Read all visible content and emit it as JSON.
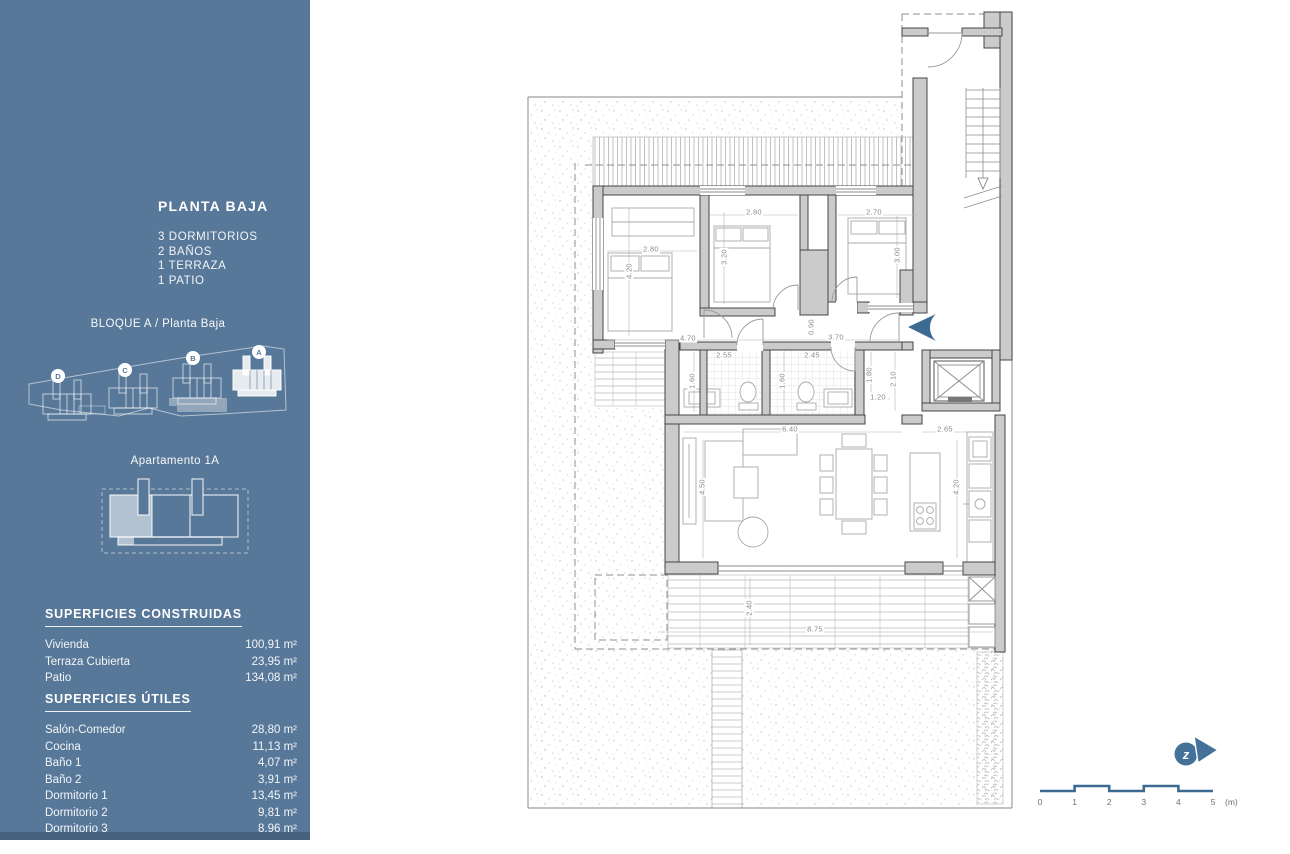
{
  "colors": {
    "sidebar_bg": "#587899",
    "sidebar_footer": "#46627f",
    "accent_blue": "#3c6a92",
    "wall_fill": "#cbcbcb",
    "wall_line": "#454545"
  },
  "sidebar": {
    "title": "PLANTA BAJA",
    "features": [
      "3 DORMITORIOS",
      "2 BAÑOS",
      "1 TERRAZA",
      "1 PATIO"
    ],
    "block_title": "BLOQUE A / Planta Baja",
    "block_units": [
      {
        "label": "D"
      },
      {
        "label": "C"
      },
      {
        "label": "B"
      },
      {
        "label": "A",
        "highlighted": true
      }
    ],
    "apartment_title": "Apartamento 1A",
    "built_areas": {
      "heading": "SUPERFICIES CONSTRUIDAS",
      "rows": [
        {
          "label": "Vivienda",
          "value": "100,91 m²"
        },
        {
          "label": "Terraza Cubierta",
          "value": "23,95 m²"
        },
        {
          "label": "Patio",
          "value": "134,08 m²"
        }
      ]
    },
    "usable_areas": {
      "heading": "SUPERFICIES ÚTILES",
      "rows": [
        {
          "label": "Salón-Comedor",
          "value": "28,80 m²"
        },
        {
          "label": "Cocina",
          "value": "11,13 m²"
        },
        {
          "label": "Baño 1",
          "value": "4,07 m²"
        },
        {
          "label": "Baño 2",
          "value": "3,91 m²"
        },
        {
          "label": "Dormitorio 1",
          "value": "13,45 m²"
        },
        {
          "label": "Dormitorio 2",
          "value": "9,81 m²"
        },
        {
          "label": "Dormitorio 3",
          "value": "8,96 m²"
        },
        {
          "label": "Paso",
          "value": "6,52 m²"
        }
      ]
    }
  },
  "plan": {
    "dimensions": [
      {
        "text": "2.80",
        "x": 754,
        "y": 212,
        "v": false
      },
      {
        "text": "2.70",
        "x": 874,
        "y": 212,
        "v": false
      },
      {
        "text": "2.80",
        "x": 651,
        "y": 249,
        "v": false
      },
      {
        "text": "4.20",
        "x": 629,
        "y": 271,
        "v": true
      },
      {
        "text": "3.20",
        "x": 724,
        "y": 257,
        "v": true
      },
      {
        "text": "3.00",
        "x": 897,
        "y": 255,
        "v": true
      },
      {
        "text": "4.70",
        "x": 688,
        "y": 338,
        "v": false
      },
      {
        "text": "3.70",
        "x": 836,
        "y": 337,
        "v": false
      },
      {
        "text": "0.90",
        "x": 811,
        "y": 327,
        "v": true
      },
      {
        "text": "2.55",
        "x": 724,
        "y": 355,
        "v": false
      },
      {
        "text": "2.45",
        "x": 812,
        "y": 355,
        "v": false
      },
      {
        "text": "1.60",
        "x": 692,
        "y": 381,
        "v": true
      },
      {
        "text": "1.60",
        "x": 782,
        "y": 381,
        "v": true
      },
      {
        "text": "1.80",
        "x": 869,
        "y": 375,
        "v": true
      },
      {
        "text": "2.10",
        "x": 893,
        "y": 379,
        "v": true
      },
      {
        "text": "1.20",
        "x": 878,
        "y": 397,
        "v": false
      },
      {
        "text": "6.40",
        "x": 790,
        "y": 429,
        "v": false
      },
      {
        "text": "2.65",
        "x": 945,
        "y": 429,
        "v": false
      },
      {
        "text": "4.50",
        "x": 702,
        "y": 487,
        "v": true
      },
      {
        "text": "4.20",
        "x": 956,
        "y": 487,
        "v": true
      },
      {
        "text": "2.40",
        "x": 749,
        "y": 608,
        "v": true
      },
      {
        "text": "8.75",
        "x": 815,
        "y": 629,
        "v": false
      }
    ],
    "scale_bar": {
      "labels": [
        "0",
        "1",
        "2",
        "3",
        "4",
        "5"
      ],
      "unit": "(m)",
      "x0": 1040,
      "step": 34.6,
      "label_y": 797
    },
    "compass_letter": "z"
  }
}
